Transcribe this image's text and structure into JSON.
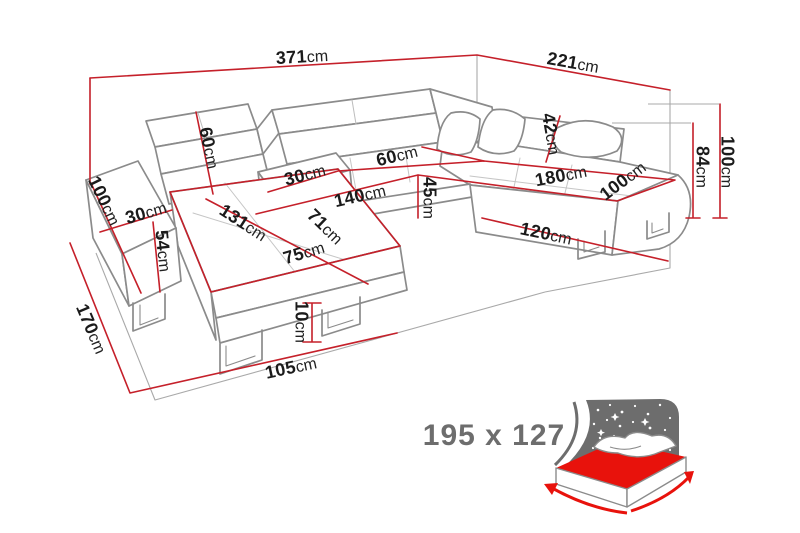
{
  "figure": {
    "type": "corner-sofa-dimension-diagram",
    "unit": "cm"
  },
  "dims": {
    "d371": {
      "v": "371",
      "u": "cm"
    },
    "d221": {
      "v": "221",
      "u": "cm"
    },
    "d60back": {
      "v": "60",
      "u": "cm"
    },
    "d100arm": {
      "v": "100",
      "u": "cm"
    },
    "d30arm": {
      "v": "30",
      "u": "cm"
    },
    "d54": {
      "v": "54",
      "u": "cm"
    },
    "d170": {
      "v": "170",
      "u": "cm"
    },
    "d105": {
      "v": "105",
      "u": "cm"
    },
    "d10": {
      "v": "10",
      "u": "cm"
    },
    "d131": {
      "v": "131",
      "u": "cm"
    },
    "d71": {
      "v": "71",
      "u": "cm"
    },
    "d75": {
      "v": "75",
      "u": "cm"
    },
    "d30console": {
      "v": "30",
      "u": "cm"
    },
    "d60seat": {
      "v": "60",
      "u": "cm"
    },
    "d140": {
      "v": "140",
      "u": "cm"
    },
    "d45": {
      "v": "45",
      "u": "cm"
    },
    "d42": {
      "v": "42",
      "u": "cm"
    },
    "d180": {
      "v": "180",
      "u": "cm"
    },
    "d100chaise": {
      "v": "100",
      "u": "cm"
    },
    "d120": {
      "v": "120",
      "u": "cm"
    },
    "d84": {
      "v": "84",
      "u": "cm"
    },
    "d100height": {
      "v": "100",
      "u": "cm"
    }
  },
  "sleeping": {
    "size": "195 x 127"
  },
  "colors": {
    "dimension_red": "#c5202a",
    "sofa_line_gray": "#8b8b8b",
    "icon_gray": "#6d6d6d",
    "mattress_red": "#e8120c",
    "label_black": "#1b1b1b"
  }
}
